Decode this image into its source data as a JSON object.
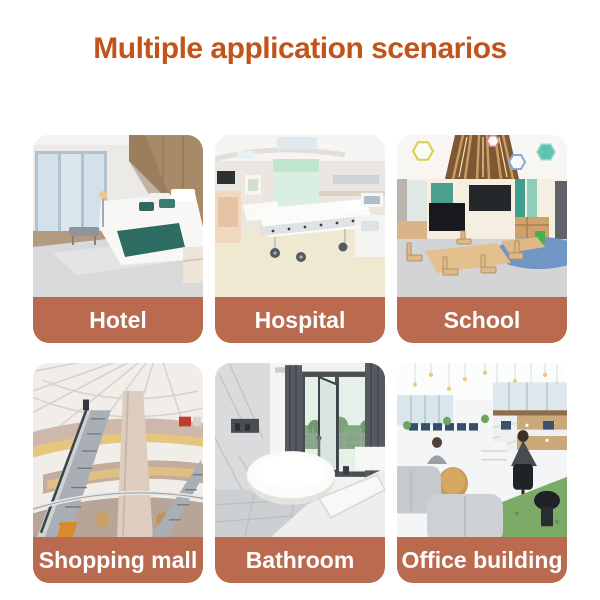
{
  "page": {
    "title": "Multiple application scenarios"
  },
  "colors": {
    "title": "#c0541a",
    "banner": "#ba6a4f",
    "label": "#ffffff",
    "background": "#ffffff"
  },
  "tiles": [
    {
      "id": "hotel",
      "label": "Hotel"
    },
    {
      "id": "hospital",
      "label": "Hospital"
    },
    {
      "id": "school",
      "label": "School"
    },
    {
      "id": "shopping-mall",
      "label": "Shopping mall"
    },
    {
      "id": "bathroom",
      "label": "Bathroom"
    },
    {
      "id": "office-building",
      "label": "Office building"
    }
  ]
}
